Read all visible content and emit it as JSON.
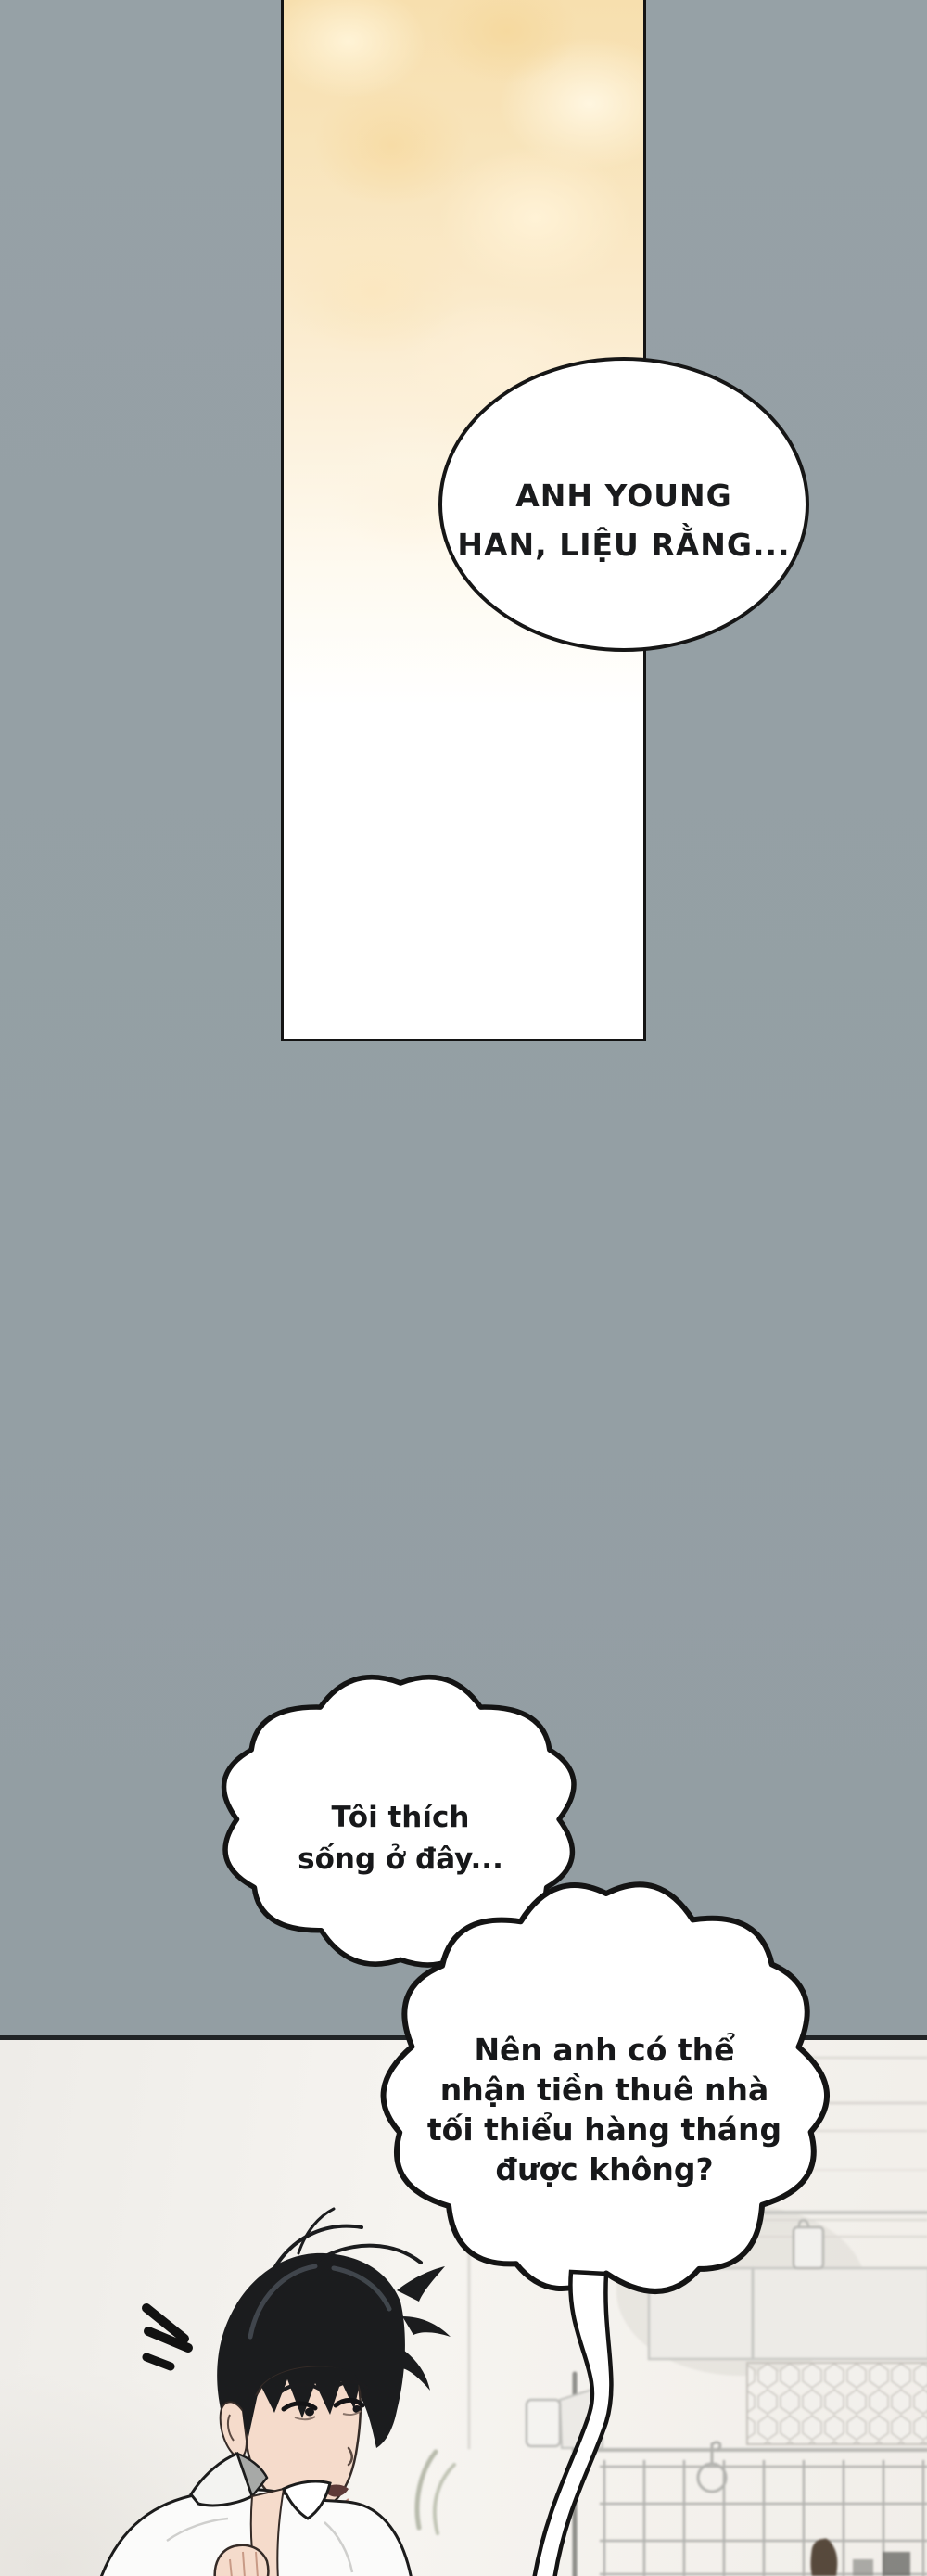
{
  "comic": {
    "bubble_ellipse": {
      "lines": [
        "ANH YOUNG",
        "HAN, LIỆU RẰNG..."
      ]
    },
    "bubble_cloud_small": {
      "lines": [
        "Tôi thích",
        "sống ở đây..."
      ]
    },
    "bubble_cloud_large": {
      "lines": [
        "Nên anh có thể",
        "nhận tiền thuê nhà",
        "tối thiểu hàng tháng",
        "được không?"
      ]
    }
  },
  "colors": {
    "bg_gray": "#96a1a6",
    "panel_cream": "#f8e2b6",
    "bubble_white": "#ffffff",
    "ink_outline": "#161616",
    "wall_offwhite": "#f4f2ee",
    "hair_black": "#1b1c1e",
    "skin": "#f5dbcb",
    "collar_gray": "#a7a9a7"
  }
}
